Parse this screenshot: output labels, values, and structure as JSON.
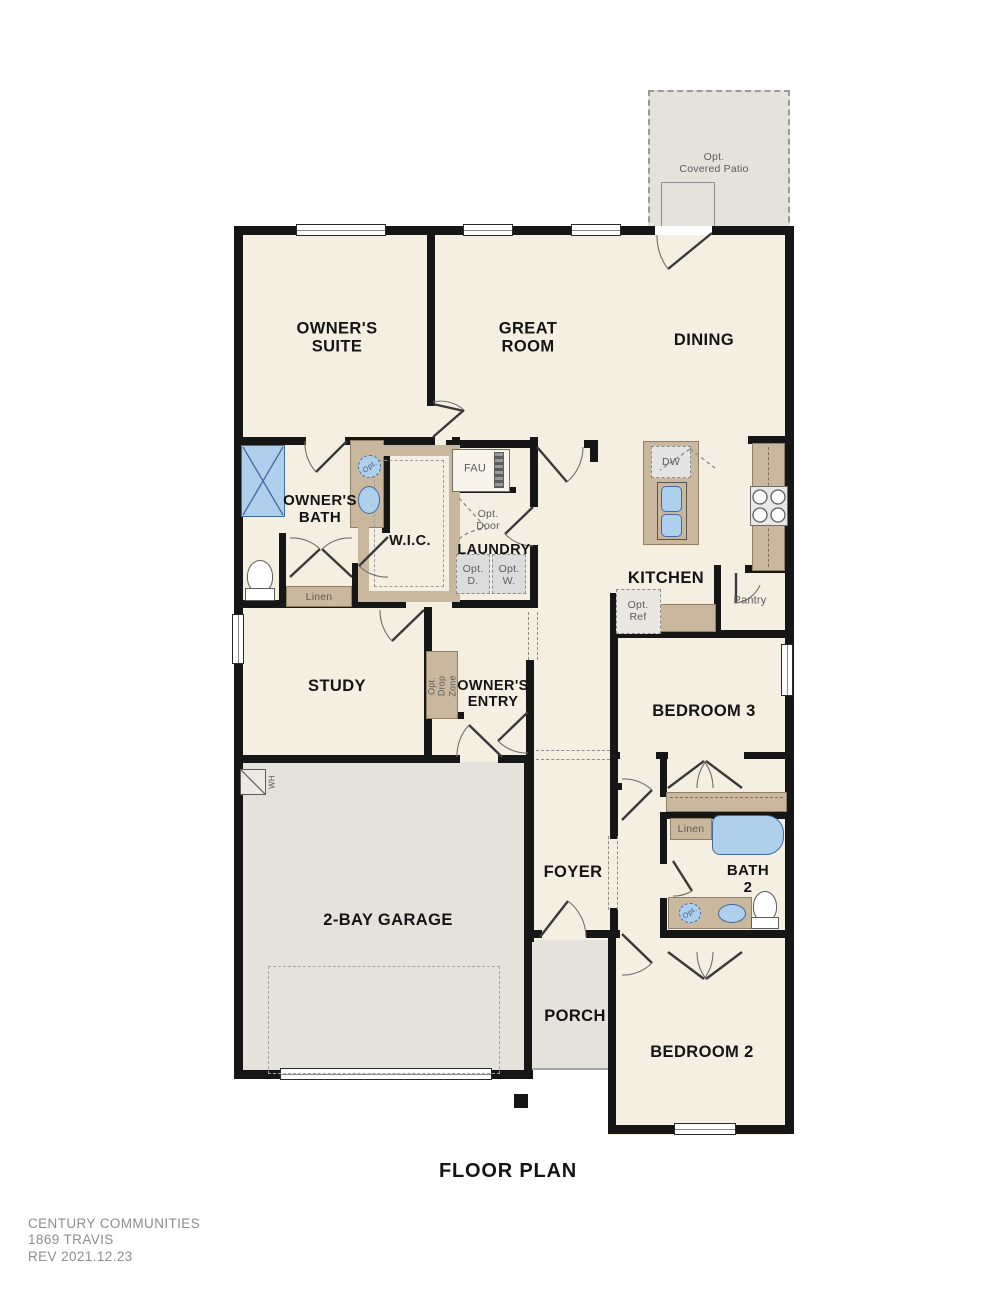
{
  "title": "FLOOR PLAN",
  "footer": {
    "company": "CENTURY COMMUNITIES",
    "plan": "1869 TRAVIS",
    "rev": "REV  2021.12.23"
  },
  "rooms": {
    "owners_suite": "OWNER'S\nSUITE",
    "great_room": "GREAT\nROOM",
    "dining": "DINING",
    "owners_bath": "OWNER'S\nBATH",
    "wic": "W.I.C.",
    "laundry": "LAUNDRY",
    "kitchen": "KITCHEN",
    "study": "STUDY",
    "owners_entry": "OWNER'S\nENTRY",
    "bedroom3": "BEDROOM 3",
    "garage": "2-BAY GARAGE",
    "foyer": "FOYER",
    "bath2": "BATH\n2",
    "porch": "PORCH",
    "bedroom2": "BEDROOM 2"
  },
  "features": {
    "opt_covered_patio": "Opt.\nCovered Patio",
    "fau": "FAU",
    "opt_door": "Opt.\nDoor",
    "opt_dryer": "Opt.\nD.",
    "opt_washer": "Opt.\nW.",
    "linen_bath1": "Linen",
    "linen_hall": "Linen",
    "dw": "DW",
    "opt_ref": "Opt.\nRef",
    "pantry": "Pantry",
    "opt_drop_zone": "Opt.\nDrop\nZone",
    "wh": "WH",
    "opt_sink_bath1": "Opt.",
    "opt_sink_bath2": "Opt."
  },
  "colors": {
    "wall": "#161616",
    "cream": "#f5efe2",
    "gray": "#e5e2dc",
    "tan": "#c9b89e",
    "tanline": "#8f7f64",
    "blue": "#aed0ec",
    "blueline": "#44699d"
  }
}
